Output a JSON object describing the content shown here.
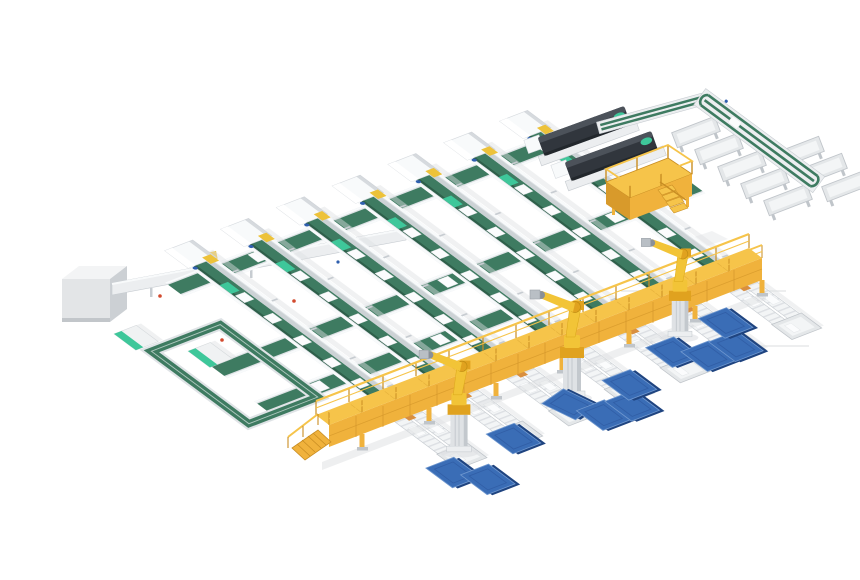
{
  "scene": {
    "title": "Isometric 3D render of an automated conveyor production and robotic panel handling line",
    "type": "3d-industrial-render",
    "background": "#ffffff",
    "inventory": {
      "main_conveyor_lines": 7,
      "line_head_machines": 7,
      "cross_transfer_belts": 3,
      "floor_loop_conveyor": 1,
      "outfeed_roller_lanes": 7,
      "outfeed_end_trays": 7,
      "elevated_gantry_walkway": 1,
      "gantry_access_ramp": 1,
      "robot_arms": 3,
      "blue_panels": 11,
      "dark_process_machines": 2,
      "takeaway_loop_line": 1,
      "side_tray_tables": 8,
      "operator_platform_with_stairs": 1,
      "control_cabinet": 1,
      "green_top_stations": 2
    },
    "colors": {
      "bg": "#ffffff",
      "beltGreen": "#3e7b61",
      "beltGreenDeep": "#2e5f4a",
      "mint": "#3ec79a",
      "frameLight": "#eceef0",
      "frameMid": "#dfe3e6",
      "frameShadow": "#c7ccd1",
      "railWhite": "#f8fafb",
      "laneReturn": "#ccd2d5",
      "rollerGray": "#f3f5f6",
      "trayGray": "#e4e7e9",
      "trayEdge": "#c0c5ca",
      "shadowSoft": "#dde0e2",
      "floorSeam": "#e7e9ea",
      "gantryTop": "#f6c44a",
      "gantryFace": "#f0b23c",
      "gantryDark": "#c98e23",
      "robotYellow": "#f2c437",
      "robotAmber": "#e0a21f",
      "jointGray": "#8a9097",
      "pedestalGray": "#dfe2e5",
      "pedestalSide": "#c3c8cd",
      "panelBlue": "#3a6db6",
      "panelBlueEdge": "#1f4480",
      "panelBlueLight": "#6e97cf",
      "machineDark": "#31363d",
      "machineTop": "#4c525a",
      "cabinetFront": "#e3e5e7",
      "cabinetSide": "#ccd0d4",
      "cabinetTop": "#f3f4f5",
      "accentYellow": "#edc23a",
      "accentRed": "#d24a2e",
      "accentBlue": "#2f5fae",
      "itemWhite": "#fbfcfd"
    }
  }
}
